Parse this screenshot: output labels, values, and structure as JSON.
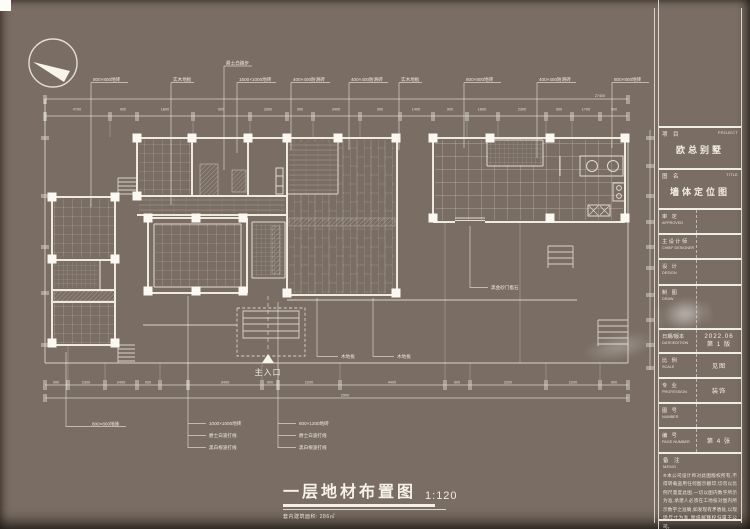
{
  "main_title": {
    "text": "一层地材布置图",
    "scale": "1:120",
    "subtitle": "套内建筑面积: 286㎡"
  },
  "plan": {
    "entrance_label": "主入口"
  },
  "callouts": {
    "c1": "800×800地砖",
    "c2": "实木地板",
    "c3": "爵士白踏步",
    "c4": "1500×1000地砖",
    "c5": "400×400防滑砖",
    "c6": "400×400防滑砖",
    "c7": "实木地板",
    "c8": "800×800地砖",
    "c9": "400×400防滑砖",
    "c10": "800×800地砖",
    "b1": "800×800地砖",
    "b2a": "1000×1000地砖",
    "b2b": "爵士白波打线",
    "b2c": "黑白根波打线",
    "b3a": "600×1200地砖",
    "b3b": "爵士白波打线",
    "b3c": "黑白根波打线",
    "w1": "木地板",
    "w2": "木地板",
    "t1": "黑金砂门槛石"
  },
  "dims": {
    "top_total": "27400",
    "top": [
      "4700",
      "900",
      "1800",
      "900",
      "3300",
      "900",
      "3400",
      "900",
      "1400",
      "900",
      "1800",
      "2300",
      "900",
      "1700",
      "900"
    ],
    "bottom": [
      "900",
      "2300",
      "2400",
      "900",
      "3400",
      "900",
      "2200",
      "4400",
      "900",
      "3200",
      "2200",
      "900"
    ],
    "bottom_total": "2900"
  },
  "titleblock": {
    "project": {
      "zh": "项 目",
      "en": "PROJECT",
      "value": "欧总别墅"
    },
    "sheet": {
      "zh": "图 名",
      "en": "TITLE",
      "value": "墙体定位图"
    },
    "approved": {
      "zh": "审 定",
      "en": "APPROVED",
      "value": ""
    },
    "chief": {
      "zh": "主设计师",
      "en": "CHIEF DESIGNER",
      "value": ""
    },
    "design": {
      "zh": "设 计",
      "en": "DESIGN",
      "value": ""
    },
    "draw": {
      "zh": "制 图",
      "en": "DRAW",
      "value": ""
    },
    "date": {
      "zh": "日期/版本",
      "en": "DATE/EDITION",
      "value1": "2022.06",
      "value2": "第 1 版"
    },
    "scale": {
      "zh": "比 例",
      "en": "SCALE",
      "value": "见图"
    },
    "profession": {
      "zh": "专 业",
      "en": "PROFESSION",
      "value": "装饰"
    },
    "number": {
      "zh": "图 号",
      "en": "NUMBER",
      "value": ""
    },
    "page": {
      "zh": "编 号",
      "en": "PAGE NUMBER",
      "value": "第 4 张"
    },
    "memo": {
      "zh": "备 注",
      "en": "MEMO",
      "text": "※本公司设计师对此图版权所有,不得转载盗用任何图示翻印,切勿以比例尺量度此图,一切以图内数字所示为准,承建人必须在工地核对图内所示数字之准确,如发现有矛盾处,以现场尺寸为准,图纸解释权归属于公司。"
    }
  },
  "colors": {
    "paper": "#7a6e64",
    "ink": "#f2ece1"
  }
}
